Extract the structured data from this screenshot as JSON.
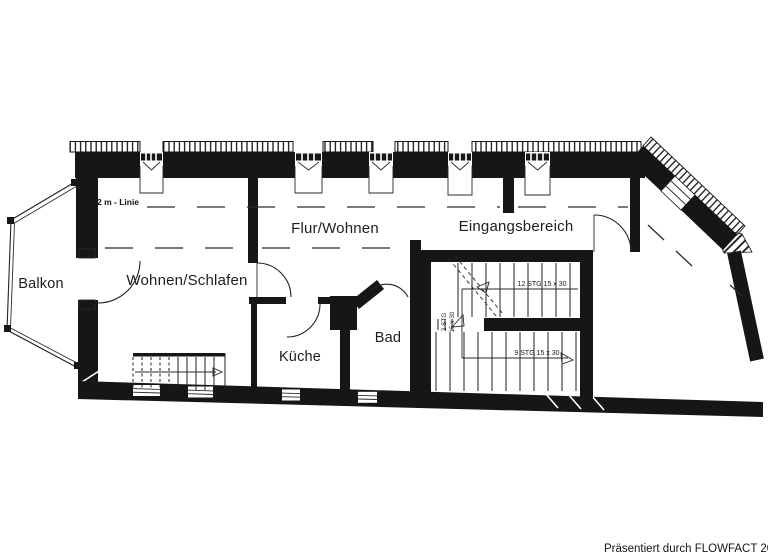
{
  "plan": {
    "rooms": [
      {
        "id": "balkon",
        "label": "Balkon"
      },
      {
        "id": "wohnen-schlafen",
        "label": "Wohnen/Schlafen"
      },
      {
        "id": "flur-wohnen",
        "label": "Flur/Wohnen"
      },
      {
        "id": "eingangsbereich",
        "label": "Eingangsbereich"
      },
      {
        "id": "kueche",
        "label": "Küche"
      },
      {
        "id": "bad",
        "label": "Bad"
      }
    ],
    "annotations": {
      "height_line_label": "2 m - Linie",
      "stair_upper": "12 STG 15 x 30",
      "stair_lower": "9 STG 15 x 30",
      "stair_landing_line1": "2 STG",
      "stair_landing_line2": "15 x 30"
    },
    "colors": {
      "ink": "#161616",
      "background": "#ffffff"
    }
  },
  "footer": {
    "credit": "Präsentiert durch FLOWFACT 20"
  }
}
